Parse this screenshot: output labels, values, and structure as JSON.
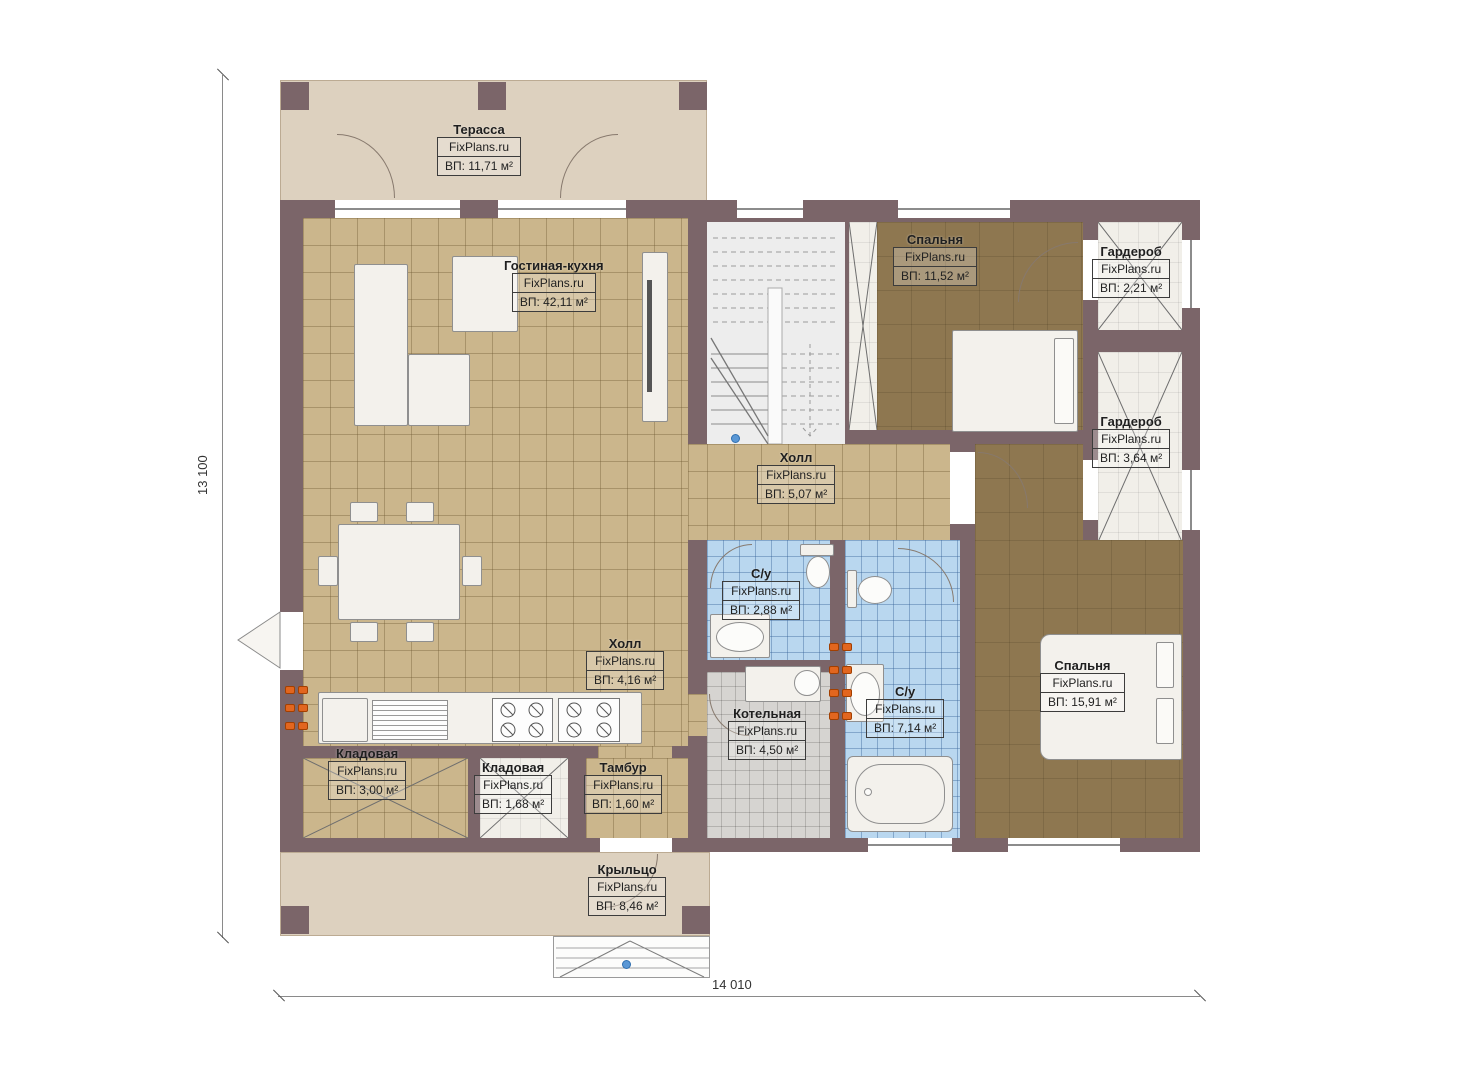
{
  "brand": "FixPlans.ru",
  "dimensions": {
    "height": "13 100",
    "width": "14 010"
  },
  "rooms": {
    "terrace": {
      "name": "Терасса",
      "area": "ВП: 11,71 м²"
    },
    "living": {
      "name": "Гостиная-кухня",
      "area": "ВП: 42,11 м²"
    },
    "bedroom1": {
      "name": "Спальня",
      "area": "ВП: 11,52 м²"
    },
    "wardrobe1": {
      "name": "Гардероб",
      "area": "ВП: 2,21 м²"
    },
    "wardrobe2": {
      "name": "Гардероб",
      "area": "ВП: 3,64 м²"
    },
    "hall_upper": {
      "name": "Холл",
      "area": "ВП: 5,07 м²"
    },
    "bath_small": {
      "name": "С/у",
      "area": "ВП: 2,88 м²"
    },
    "hall_lower": {
      "name": "Холл",
      "area": "ВП: 4,16 м²"
    },
    "boiler": {
      "name": "Котельная",
      "area": "ВП: 4,50 м²"
    },
    "bath_big": {
      "name": "С/у",
      "area": "ВП: 7,14 м²"
    },
    "bedroom2": {
      "name": "Спальня",
      "area": "ВП: 15,91 м²"
    },
    "storage1": {
      "name": "Кладовая",
      "area": "ВП: 3,00 м²"
    },
    "storage2": {
      "name": "Кладовая",
      "area": "ВП: 1,68 м²"
    },
    "tambour": {
      "name": "Тамбур",
      "area": "ВП: 1,60 м²"
    },
    "porch": {
      "name": "Крыльцо",
      "area": "ВП: 8,46 м²"
    }
  },
  "colors": {
    "wall": "#7b6569",
    "floor_tan": "#cbb68c",
    "floor_brown": "#8e7750",
    "tile_blue": "#b9d7ef",
    "tile_gray": "#d6d4d1",
    "terrace": "#ddd1bf",
    "light": "#f1efe9",
    "stairs": "#ededed",
    "radiator": "#e2661f",
    "marker_blue": "#5a97d5"
  }
}
